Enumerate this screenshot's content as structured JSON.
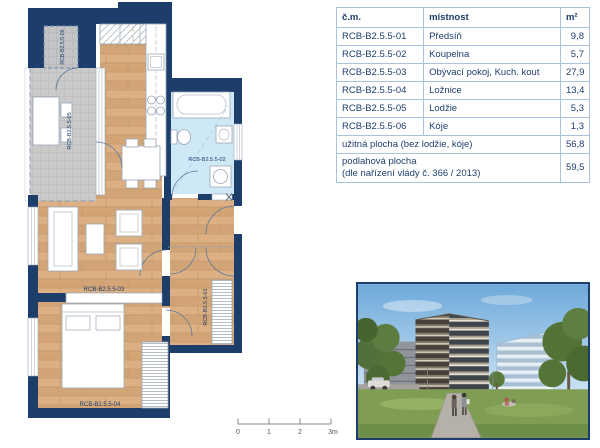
{
  "plan": {
    "labels": {
      "room01": "RCB-B2.5.5-01",
      "room02": "RCB-B2.5.5-02",
      "room03": "RCB-B2.5.5-03",
      "room04": "RCB-B2.5.5-04",
      "room05": "RCB-B2.5.5-05",
      "room06": "RCB-B2.5.5-06"
    },
    "scale_ticks": [
      "0",
      "1",
      "2",
      "3m"
    ]
  },
  "table": {
    "headers": {
      "code": "č.m.",
      "room": "místnost",
      "area": "m²"
    },
    "rows": [
      {
        "code": "RCB-B2.5.5-01",
        "room": "Předsíň",
        "area": "9,8"
      },
      {
        "code": "RCB-B2.5.5-02",
        "room": "Koupelna",
        "area": "5,7"
      },
      {
        "code": "RCB-B2.5.5-03",
        "room": "Obývací pokoj, Kuch. kout",
        "area": "27,9"
      },
      {
        "code": "RCB-B2.5.5-04",
        "room": "Ložnice",
        "area": "13,4"
      },
      {
        "code": "RCB-B2.5.5-05",
        "room": "Lodžie",
        "area": "5,3"
      },
      {
        "code": "RCB-B2.5.5-06",
        "room": "Kóje",
        "area": "1,3"
      }
    ],
    "summary": [
      {
        "label": "užitná plocha (bez lodžie, kóje)",
        "label2": "",
        "value": "56,8"
      },
      {
        "label": "podlahová plocha",
        "label2": "(dle nařízení vlády č. 366 / 2013)",
        "value": "59,5"
      }
    ]
  },
  "colors": {
    "navy": "#1d3e6b",
    "table_border": "#a9c2de",
    "wood": "#d9ac7c",
    "bathroom_blue": "#cfe8f6",
    "loggia_gray": "#cacaca"
  }
}
